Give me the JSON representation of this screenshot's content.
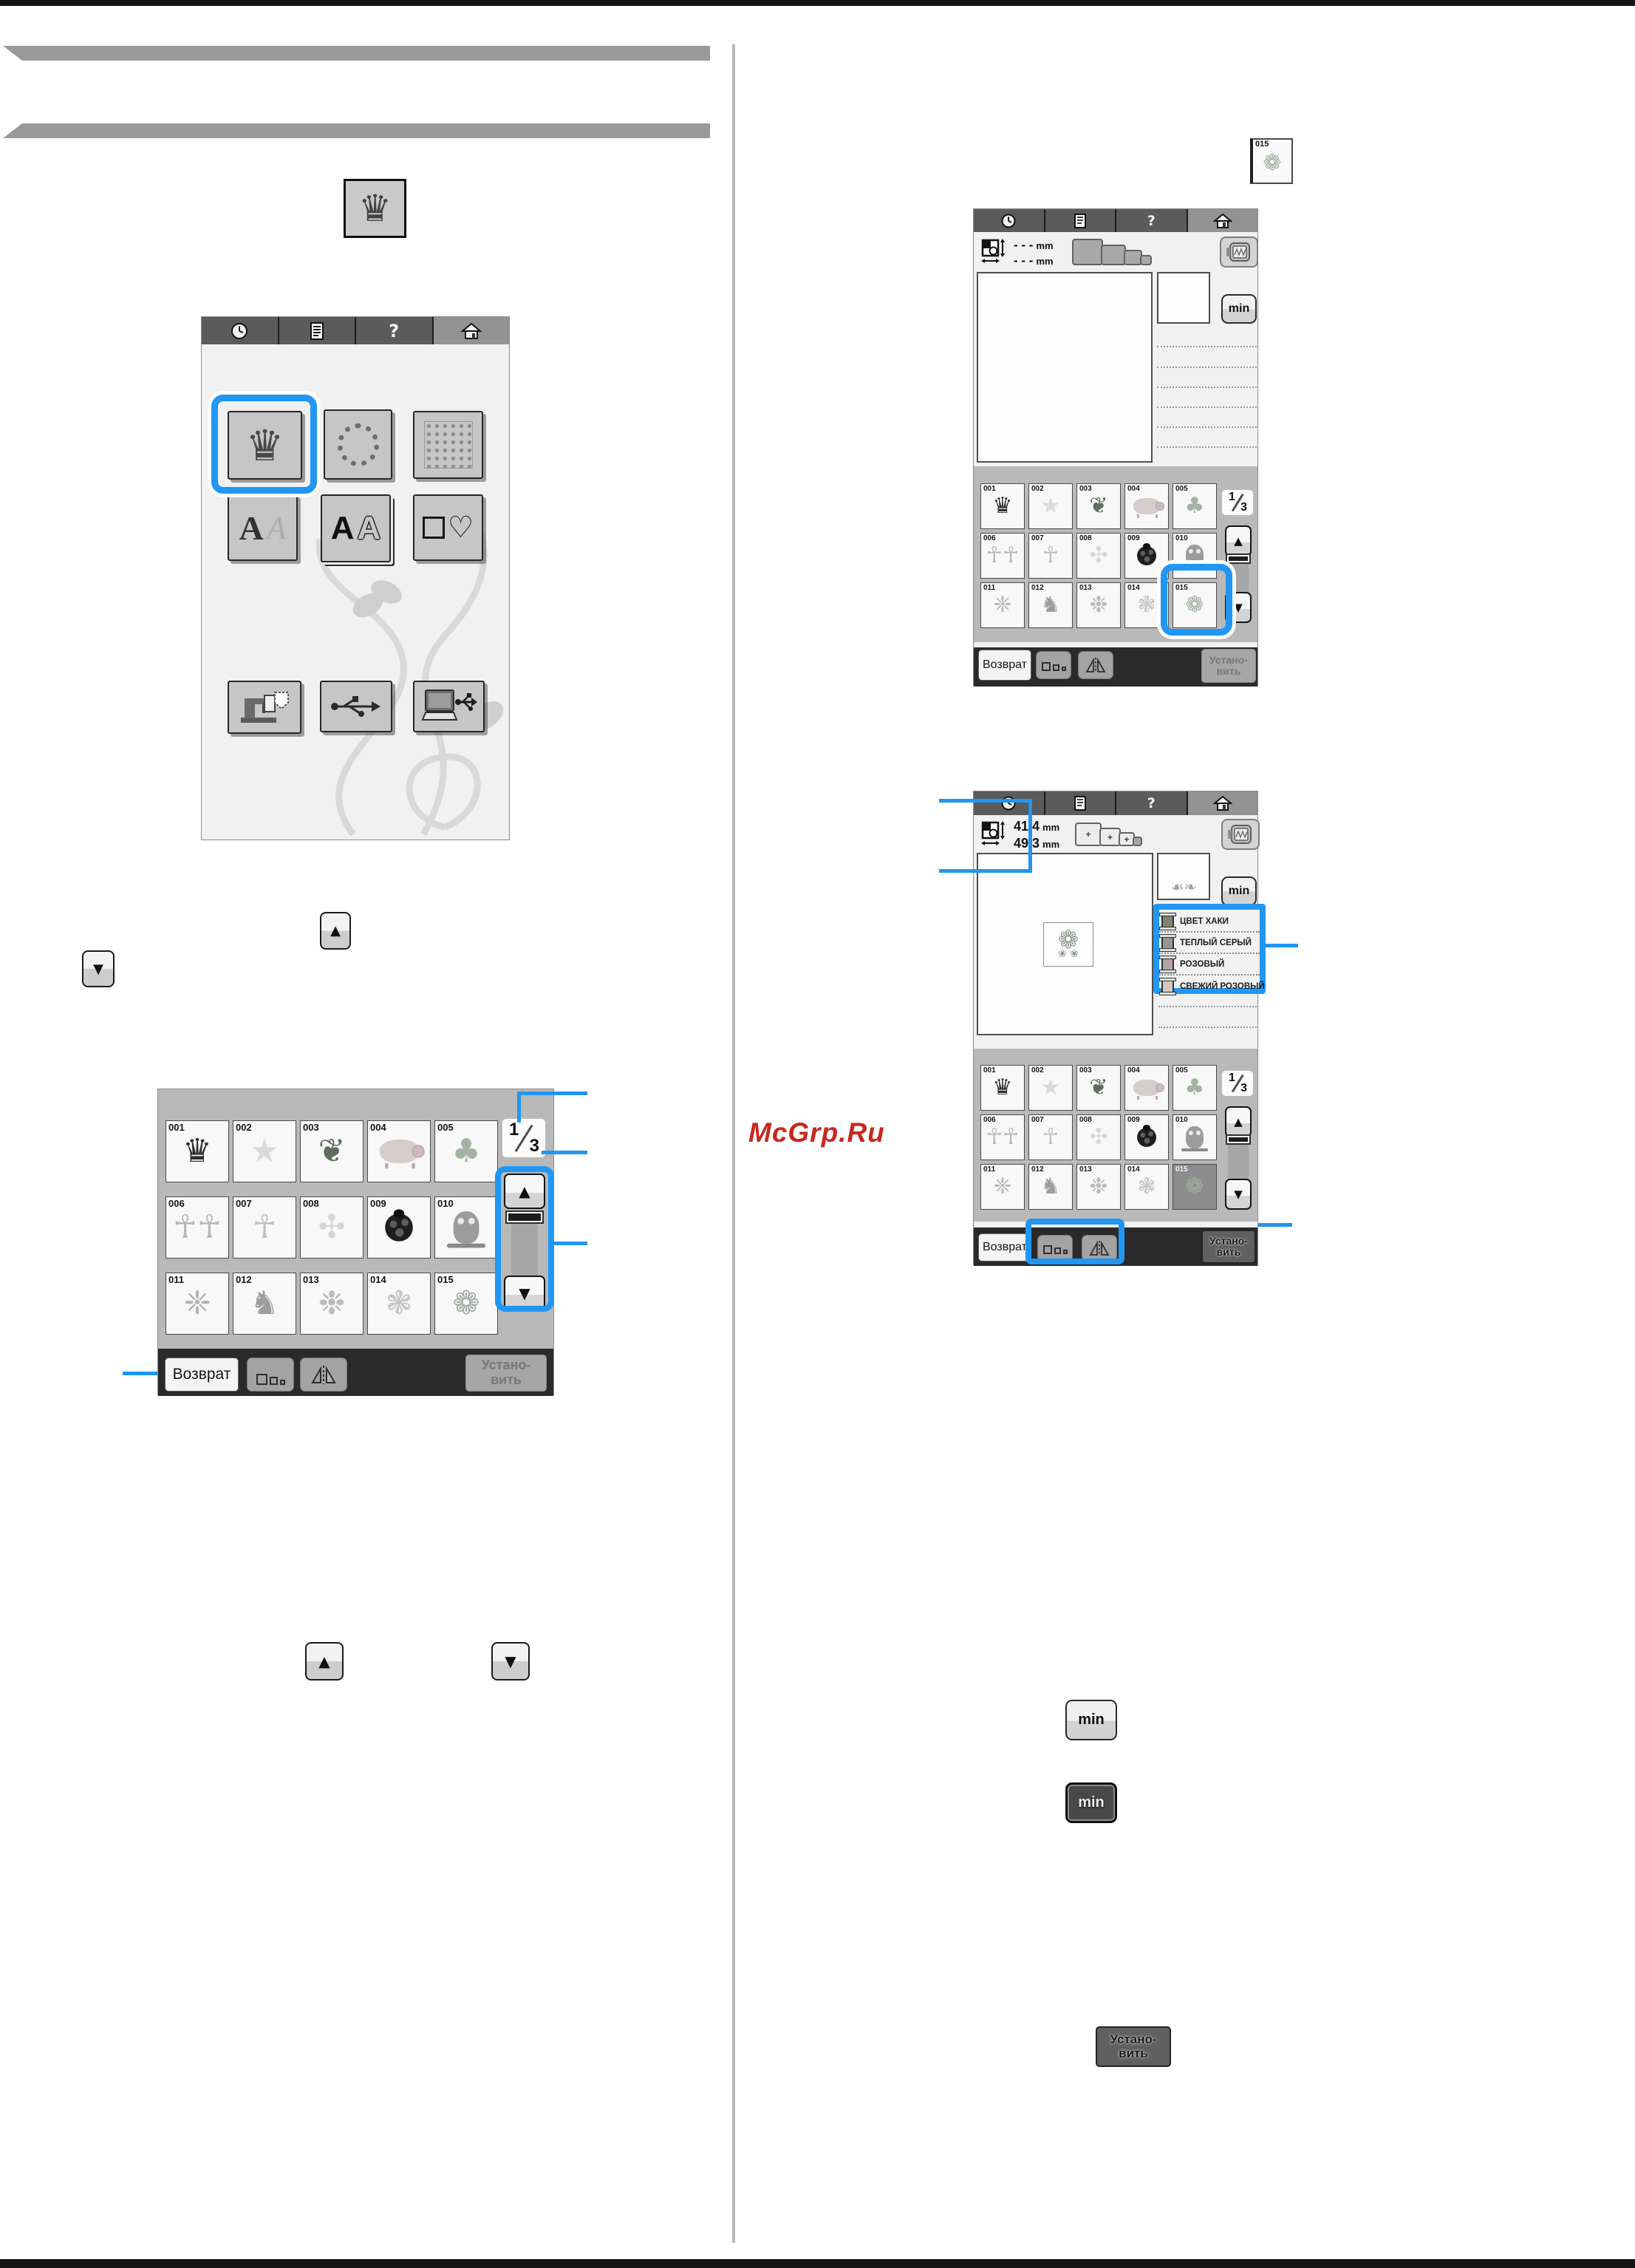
{
  "accent": "#2196f3",
  "watermark": {
    "text": "McGrp.Ru",
    "color": "#c8281e"
  },
  "topbar": {
    "help": "?"
  },
  "indicator": {
    "current": "1",
    "total": "3"
  },
  "buttons": {
    "return": "Возврат",
    "set_line1": "Устано-",
    "set_line2": "вить",
    "min": "min"
  },
  "size_panel": {
    "empty": "- - -",
    "unit": "mm",
    "width": "41.4",
    "height": "49.3",
    "hoop_plus": "+"
  },
  "thread_colors": [
    {
      "name": "ЦВЕТ ХАКИ",
      "swatch": "#82826f"
    },
    {
      "name": "ТЕПЛЫЙ СЕРЫЙ",
      "swatch": "#98988f"
    },
    {
      "name": "РОЗОВЫЙ",
      "swatch": "#b4a4a4"
    },
    {
      "name": "СВЕЖИЙ РОЗОВЫЙ",
      "swatch": "#d5c6c6"
    }
  ],
  "selected_id": "015",
  "thumb": {
    "id": "015",
    "glyph": "❁",
    "color": "#9fae9f"
  },
  "preview_pattern": {
    "glyph": "❁",
    "sub": "❀ ❀",
    "color": "#8c9c8c"
  },
  "mini_pattern": {
    "glyph": "☙❧",
    "color": "#a3a3a3"
  },
  "tiles": [
    {
      "id": "001",
      "glyph": "♛",
      "color": "#2e2e2e"
    },
    {
      "id": "002",
      "glyph": "★",
      "color": "#dadada"
    },
    {
      "id": "003",
      "glyph": "❦",
      "color": "#5e6e5e"
    },
    {
      "id": "004",
      "shape": "pig"
    },
    {
      "id": "005",
      "glyph": "♣",
      "color": "#a3b3a3"
    },
    {
      "id": "006",
      "glyph": "☥☥",
      "color": "#b7b7b7"
    },
    {
      "id": "007",
      "glyph": "☥",
      "color": "#bfbfbf"
    },
    {
      "id": "008",
      "glyph": "✣",
      "color": "#d6d6d6"
    },
    {
      "id": "009",
      "shape": "bug"
    },
    {
      "id": "010",
      "shape": "owl"
    },
    {
      "id": "011",
      "glyph": "❈",
      "color": "#b5b5b5"
    },
    {
      "id": "012",
      "glyph": "♞",
      "color": "#9e9e9e"
    },
    {
      "id": "013",
      "glyph": "❉",
      "color": "#bbbbbb"
    },
    {
      "id": "014",
      "glyph": "❃",
      "color": "#c6c6c6"
    },
    {
      "id": "015",
      "glyph": "❁",
      "color": "#9fae9f"
    }
  ]
}
